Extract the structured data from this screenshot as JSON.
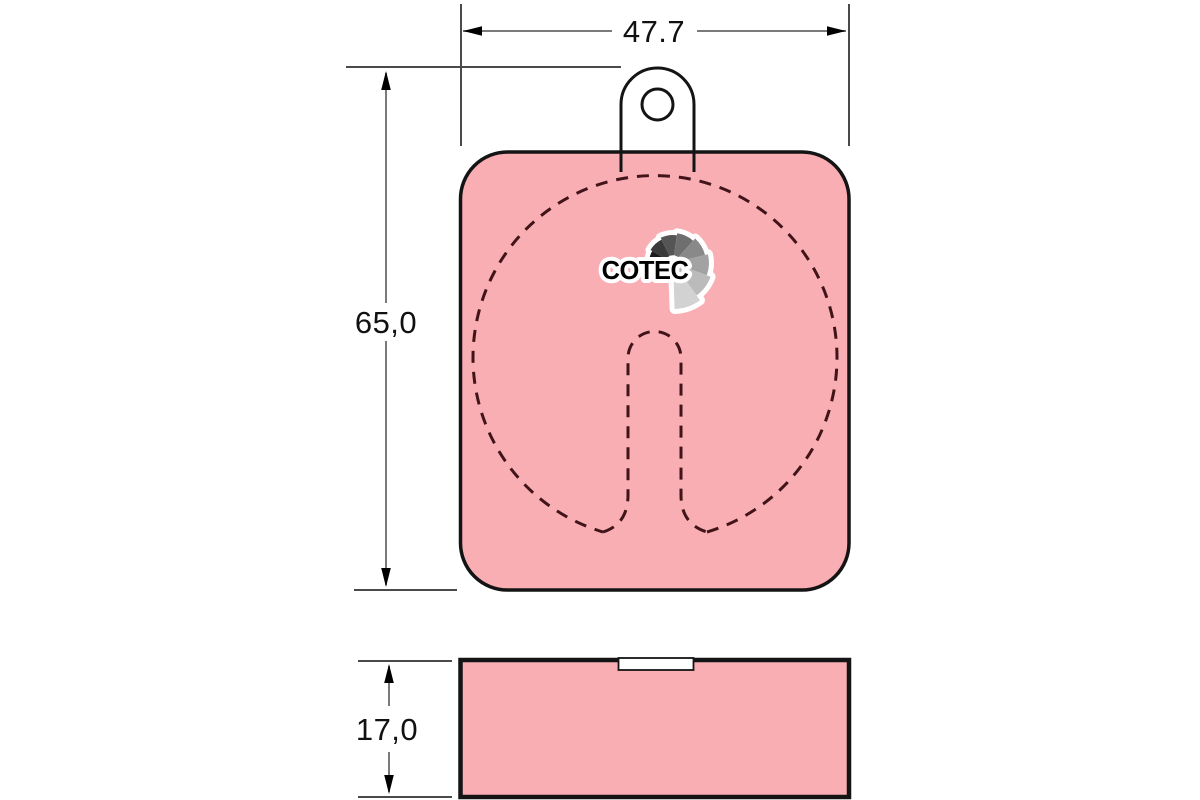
{
  "colors": {
    "background": "#ffffff",
    "pad_fill": "#f9aeb4",
    "outline": "#141414",
    "contact_dash": "#401418",
    "dimension_line": "#7a7a7a",
    "extension_line": "#4a4a4a",
    "arrow": "#000000",
    "dimension_text": "#111111",
    "logo_text_color": "#000000"
  },
  "logo": {
    "text": "COTEC",
    "fan_colors": [
      "#1b1b1b",
      "#3a3a3a",
      "#555555",
      "#6f6f6f",
      "#898989",
      "#a2a2a2",
      "#bbbbbb",
      "#d2d2d2"
    ]
  },
  "dimensions": {
    "width": {
      "label": "47.7"
    },
    "height": {
      "label": "65,0"
    },
    "thickness": {
      "label": "17,0"
    }
  }
}
